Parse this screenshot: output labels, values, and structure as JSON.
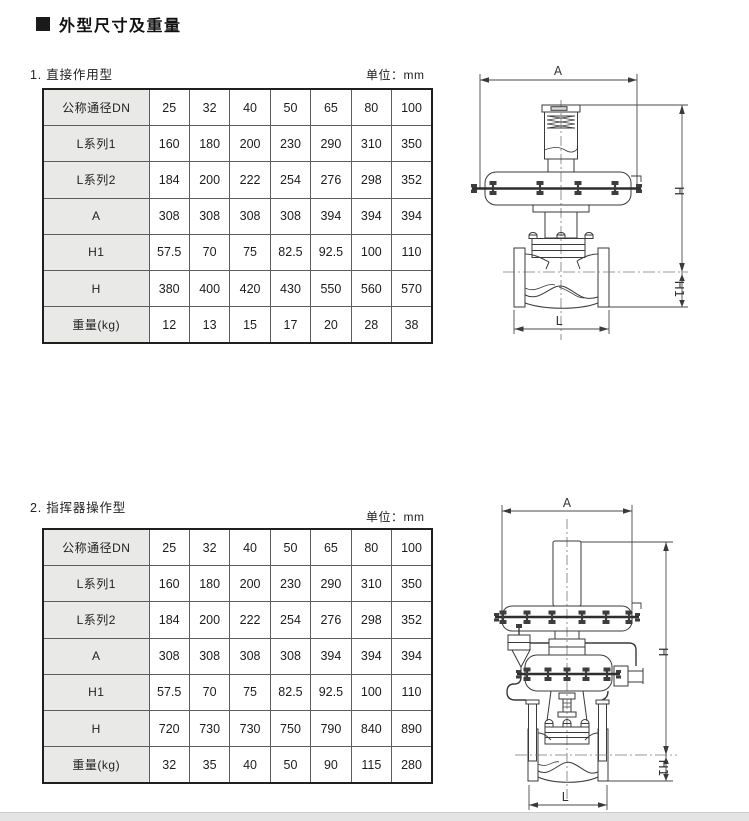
{
  "page": {
    "title": "外型尺寸及重量"
  },
  "sections": [
    {
      "heading": "1. 直接作用型",
      "unit_label": "单位：mm",
      "table": {
        "rows": [
          {
            "header": "公称通径DN",
            "cells": [
              "25",
              "32",
              "40",
              "50",
              "65",
              "80",
              "100"
            ]
          },
          {
            "header": "L系列1",
            "cells": [
              "160",
              "180",
              "200",
              "230",
              "290",
              "310",
              "350"
            ]
          },
          {
            "header": "L系列2",
            "cells": [
              "184",
              "200",
              "222",
              "254",
              "276",
              "298",
              "352"
            ]
          },
          {
            "header": "A",
            "cells": [
              "308",
              "308",
              "308",
              "308",
              "394",
              "394",
              "394"
            ]
          },
          {
            "header": "H1",
            "cells": [
              "57.5",
              "70",
              "75",
              "82.5",
              "92.5",
              "100",
              "110"
            ]
          },
          {
            "header": "H",
            "cells": [
              "380",
              "400",
              "420",
              "430",
              "550",
              "560",
              "570"
            ]
          },
          {
            "header": "重量(kg)",
            "cells": [
              "12",
              "13",
              "15",
              "17",
              "20",
              "28",
              "38"
            ]
          }
        ]
      },
      "diagram": {
        "labels": {
          "A": "A",
          "H": "H",
          "H1": "H1",
          "L": "L"
        }
      }
    },
    {
      "heading": "2. 指挥器操作型",
      "unit_label": "单位：mm",
      "table": {
        "rows": [
          {
            "header": "公称通径DN",
            "cells": [
              "25",
              "32",
              "40",
              "50",
              "65",
              "80",
              "100"
            ]
          },
          {
            "header": "L系列1",
            "cells": [
              "160",
              "180",
              "200",
              "230",
              "290",
              "310",
              "350"
            ]
          },
          {
            "header": "L系列2",
            "cells": [
              "184",
              "200",
              "222",
              "254",
              "276",
              "298",
              "352"
            ]
          },
          {
            "header": "A",
            "cells": [
              "308",
              "308",
              "308",
              "308",
              "394",
              "394",
              "394"
            ]
          },
          {
            "header": "H1",
            "cells": [
              "57.5",
              "70",
              "75",
              "82.5",
              "92.5",
              "100",
              "110"
            ]
          },
          {
            "header": "H",
            "cells": [
              "720",
              "730",
              "730",
              "750",
              "790",
              "840",
              "890"
            ]
          },
          {
            "header": "重量(kg)",
            "cells": [
              "32",
              "35",
              "40",
              "50",
              "90",
              "115",
              "280"
            ]
          }
        ]
      },
      "diagram": {
        "labels": {
          "A": "A",
          "H": "H",
          "H1": "H1",
          "L": "L"
        }
      }
    }
  ],
  "colors": {
    "header_cell_bg": "#e9e9e8",
    "line_art": "#3a3a3a",
    "bottom_bar": "#e4e4e4"
  }
}
